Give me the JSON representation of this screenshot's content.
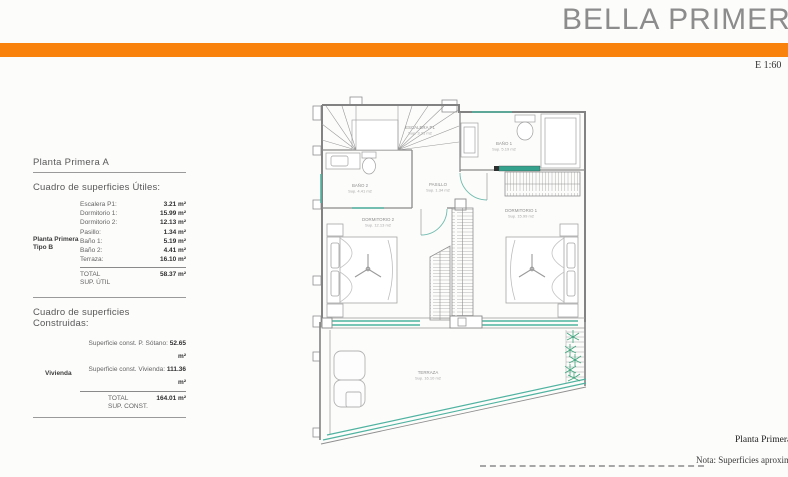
{
  "header": {
    "title": "BELLA PRIMERA A",
    "scale": "E 1:60",
    "accent_color": "#F8820C"
  },
  "left_panel": {
    "plan_heading": "Planta Primera A",
    "utiles": {
      "table_title": "Cuadro de superficies Útiles:",
      "group_label_line1": "Planta Primera",
      "group_label_line2": "Tipo B",
      "rows": [
        {
          "label": "Escalera P1:",
          "value": "3.21 m²"
        },
        {
          "label": "Dormitorio 1:",
          "value": "15.99 m²"
        },
        {
          "label": "Dormitorio 2:",
          "value": "12.13 m²"
        },
        {
          "label": "Pasillo:",
          "value": "1.34 m²"
        },
        {
          "label": "Baño 1:",
          "value": "5.19 m²"
        },
        {
          "label": "Baño 2:",
          "value": "4.41 m²"
        },
        {
          "label": "Terraza:",
          "value": "16.10 m²"
        }
      ],
      "total_label_line1": "TOTAL",
      "total_label_line2": "SUP. ÚTIL",
      "total_value": "58.37 m²"
    },
    "construidas": {
      "table_title": "Cuadro de superficies Construidas:",
      "group_label": "Vivienda",
      "rows": [
        {
          "label": "Superficie const. P. Sótano: ",
          "value": "52.65 m²"
        },
        {
          "label": "Superficie const. Vivienda: ",
          "value": "111.36 m²"
        }
      ],
      "total_label_line1": "TOTAL",
      "total_label_line2": "SUP. CONST.",
      "total_value": "164.01 m²"
    }
  },
  "plan": {
    "window_color": "#4fb3a0",
    "rooms": [
      {
        "name": "ESCALERA P1",
        "area": "Sup. 3.21 m2"
      },
      {
        "name": "BAÑO 2",
        "area": "Sup. 4.41 m2"
      },
      {
        "name": "PASILLO",
        "area": "Sup. 1.34 m2"
      },
      {
        "name": "BAÑO 1",
        "area": "Sup. 5.19 m2"
      },
      {
        "name": "DORMITORIO 2",
        "area": "Sup. 12.13 m2"
      },
      {
        "name": "DORMITORIO 1",
        "area": "Sup. 15.99 m2"
      },
      {
        "name": "TERRAZA",
        "area": "Sup. 16.10 m2"
      }
    ]
  },
  "footer": {
    "plan_caption": "Planta Primera",
    "note": "Nota: Superficies aproximadas"
  }
}
